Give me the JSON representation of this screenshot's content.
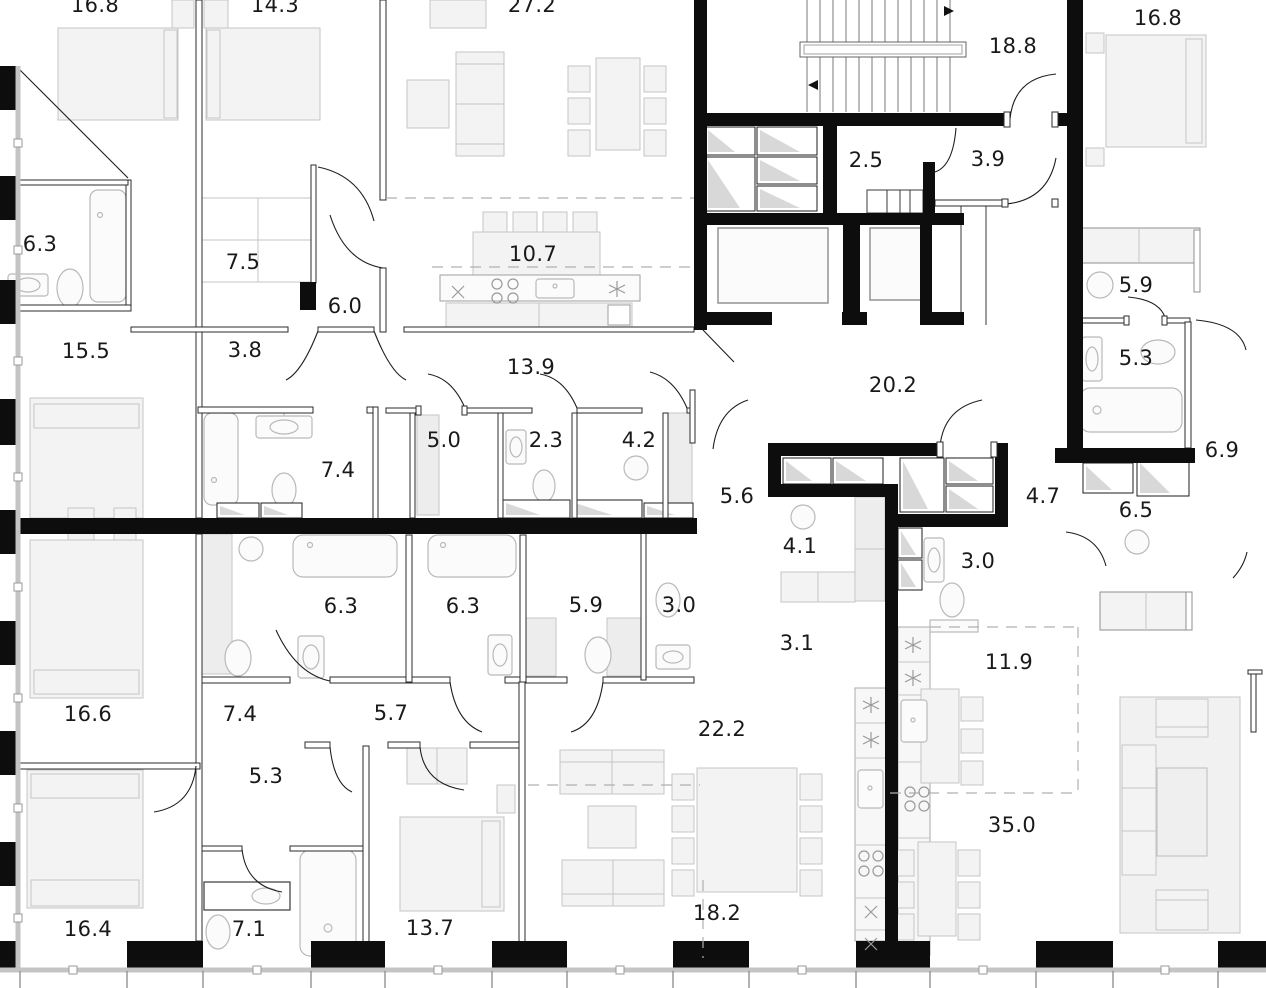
{
  "meta": {
    "type": "architectural-floor-plan",
    "units": "square-meters",
    "colors": {
      "wall": "#0d0d0d",
      "partition": "#2b2b2b",
      "furniture_stroke": "#c6c6c6",
      "furniture_fill": "#f3f3f3",
      "fixture_stroke": "#b9b9b9",
      "dashed_zone": "#b0b0b0",
      "window_band": "#c4c4c4",
      "label_text": "#191919"
    }
  },
  "rooms": [
    {
      "name": "bedroom-top-left",
      "area": "16.8"
    },
    {
      "name": "bedroom-top-mid",
      "area": "14.3"
    },
    {
      "name": "living-top",
      "area": "27.2"
    },
    {
      "name": "stairwell",
      "area": "18.8"
    },
    {
      "name": "bedroom-top-right",
      "area": "16.8"
    },
    {
      "name": "closet-top",
      "area": "2.5"
    },
    {
      "name": "hall-top",
      "area": "3.9"
    },
    {
      "name": "bathroom-left",
      "area": "6.3"
    },
    {
      "name": "corridor-left",
      "area": "7.5"
    },
    {
      "name": "kitchen-top",
      "area": "10.7"
    },
    {
      "name": "entry-left",
      "area": "6.0"
    },
    {
      "name": "laundry-right",
      "area": "5.9"
    },
    {
      "name": "bedroom-mid-left",
      "area": "15.5"
    },
    {
      "name": "corridor-mid",
      "area": "3.8"
    },
    {
      "name": "kitchen-corridor",
      "area": "13.9"
    },
    {
      "name": "bathroom-right",
      "area": "5.3"
    },
    {
      "name": "hall-central",
      "area": "20.2"
    },
    {
      "name": "wardrobe-a",
      "area": "5.0"
    },
    {
      "name": "bathroom-small",
      "area": "2.3"
    },
    {
      "name": "laundry-a",
      "area": "4.2"
    },
    {
      "name": "niche-right",
      "area": "6.9"
    },
    {
      "name": "bathroom-mid",
      "area": "7.4"
    },
    {
      "name": "hallway-a",
      "area": "5.6"
    },
    {
      "name": "hallway-b",
      "area": "4.7"
    },
    {
      "name": "hallway-right",
      "area": "6.5"
    },
    {
      "name": "laundry-b",
      "area": "4.1"
    },
    {
      "name": "bathroom-c",
      "area": "3.0"
    },
    {
      "name": "bathroom-d",
      "area": "6.3"
    },
    {
      "name": "bathroom-e",
      "area": "6.3"
    },
    {
      "name": "bathroom-f",
      "area": "5.9"
    },
    {
      "name": "bathroom-g",
      "area": "3.0"
    },
    {
      "name": "closet-b",
      "area": "3.1"
    },
    {
      "name": "kitchen-right",
      "area": "11.9"
    },
    {
      "name": "bedroom-left-2",
      "area": "16.6"
    },
    {
      "name": "hallway-c",
      "area": "7.4"
    },
    {
      "name": "hallway-d",
      "area": "5.7"
    },
    {
      "name": "living-left",
      "area": "22.2"
    },
    {
      "name": "hallway-e",
      "area": "5.3"
    },
    {
      "name": "living-right",
      "area": "35.0"
    },
    {
      "name": "bedroom-bottom-left",
      "area": "16.4"
    },
    {
      "name": "bathroom-bottom",
      "area": "7.1"
    },
    {
      "name": "bedroom-bottom-mid",
      "area": "13.7"
    },
    {
      "name": "dining-bottom",
      "area": "18.2"
    }
  ]
}
